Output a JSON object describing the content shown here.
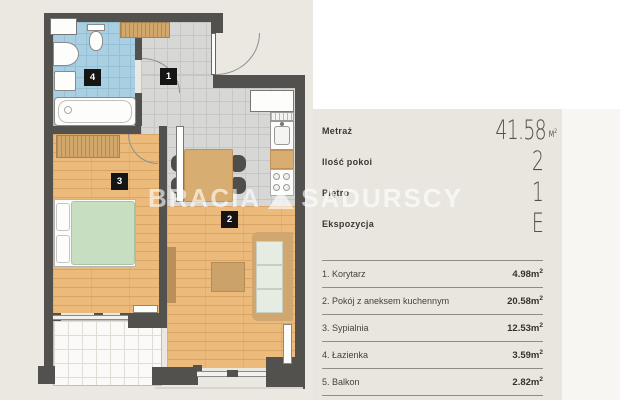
{
  "brand": {
    "left": "BRACIA",
    "right": "SADURSCY"
  },
  "summary": {
    "rows": [
      {
        "label": "Metraż",
        "value": "41.58",
        "unit_base": "M",
        "unit_sup": "2"
      },
      {
        "label": "Ilość pokoi",
        "value": "2"
      },
      {
        "label": "Piętro",
        "value": "1"
      },
      {
        "label": "Ekspozycja",
        "value": "E"
      }
    ]
  },
  "rooms": {
    "rows": [
      {
        "label": "1. Korytarz",
        "area": "4.98",
        "unit_base": "m",
        "unit_sup": "2"
      },
      {
        "label": "2. Pokój z aneksem kuchennym",
        "area": "20.58",
        "unit_base": "m",
        "unit_sup": "2"
      },
      {
        "label": "3. Sypialnia",
        "area": "12.53",
        "unit_base": "m",
        "unit_sup": "2"
      },
      {
        "label": "4. Łazienka",
        "area": "3.59",
        "unit_base": "m",
        "unit_sup": "2"
      },
      {
        "label": "5. Balkon",
        "area": "2.82",
        "unit_base": "m",
        "unit_sup": "2"
      }
    ]
  },
  "floorplan": {
    "tags": {
      "hall": "1",
      "living": "2",
      "bedroom": "3",
      "bathroom": "4"
    }
  },
  "colors": {
    "page_bg": "#ebe8e1",
    "panel_bg": "#e9e6df",
    "wall": "#53514e",
    "wood_floor": "#ecba7b",
    "tile_floor": "#d7d7d5",
    "bathroom_floor": "#a9cfe2",
    "bed_green": "#c7dec1",
    "furniture_tan": "#d7ad72",
    "watermark": "rgba(255,255,255,0.62)"
  }
}
